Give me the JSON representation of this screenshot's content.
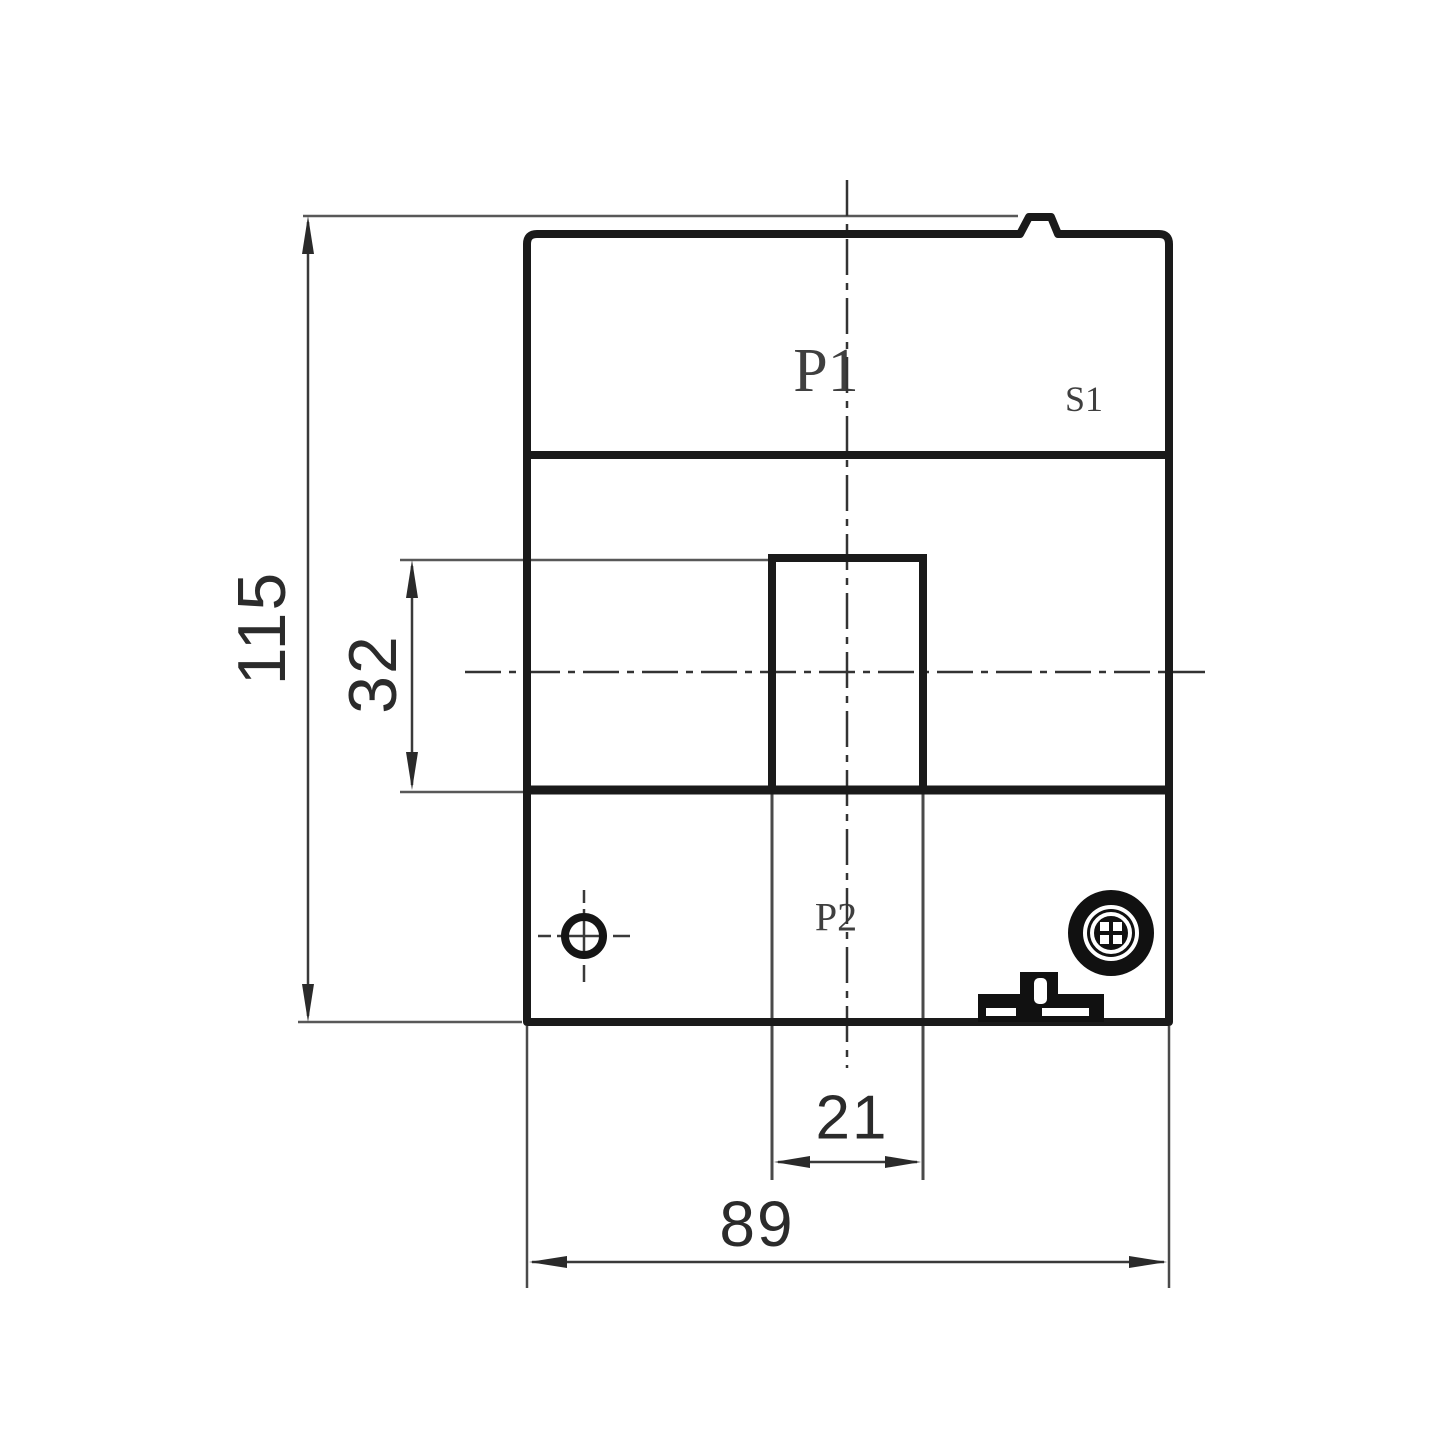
{
  "drawing": {
    "kind": "technical-dimension-drawing-front-view",
    "labels": {
      "p1": "P1",
      "s1": "S1",
      "p2": "P2"
    },
    "dimensions": {
      "overall_height": "115",
      "window_height": "32",
      "window_width": "21",
      "overall_width": "89"
    },
    "colors": {
      "background": "#ffffff",
      "main_line": "#1a1a1a",
      "thin_line": "#4a4a4a",
      "text": "#2b2b2b"
    }
  }
}
